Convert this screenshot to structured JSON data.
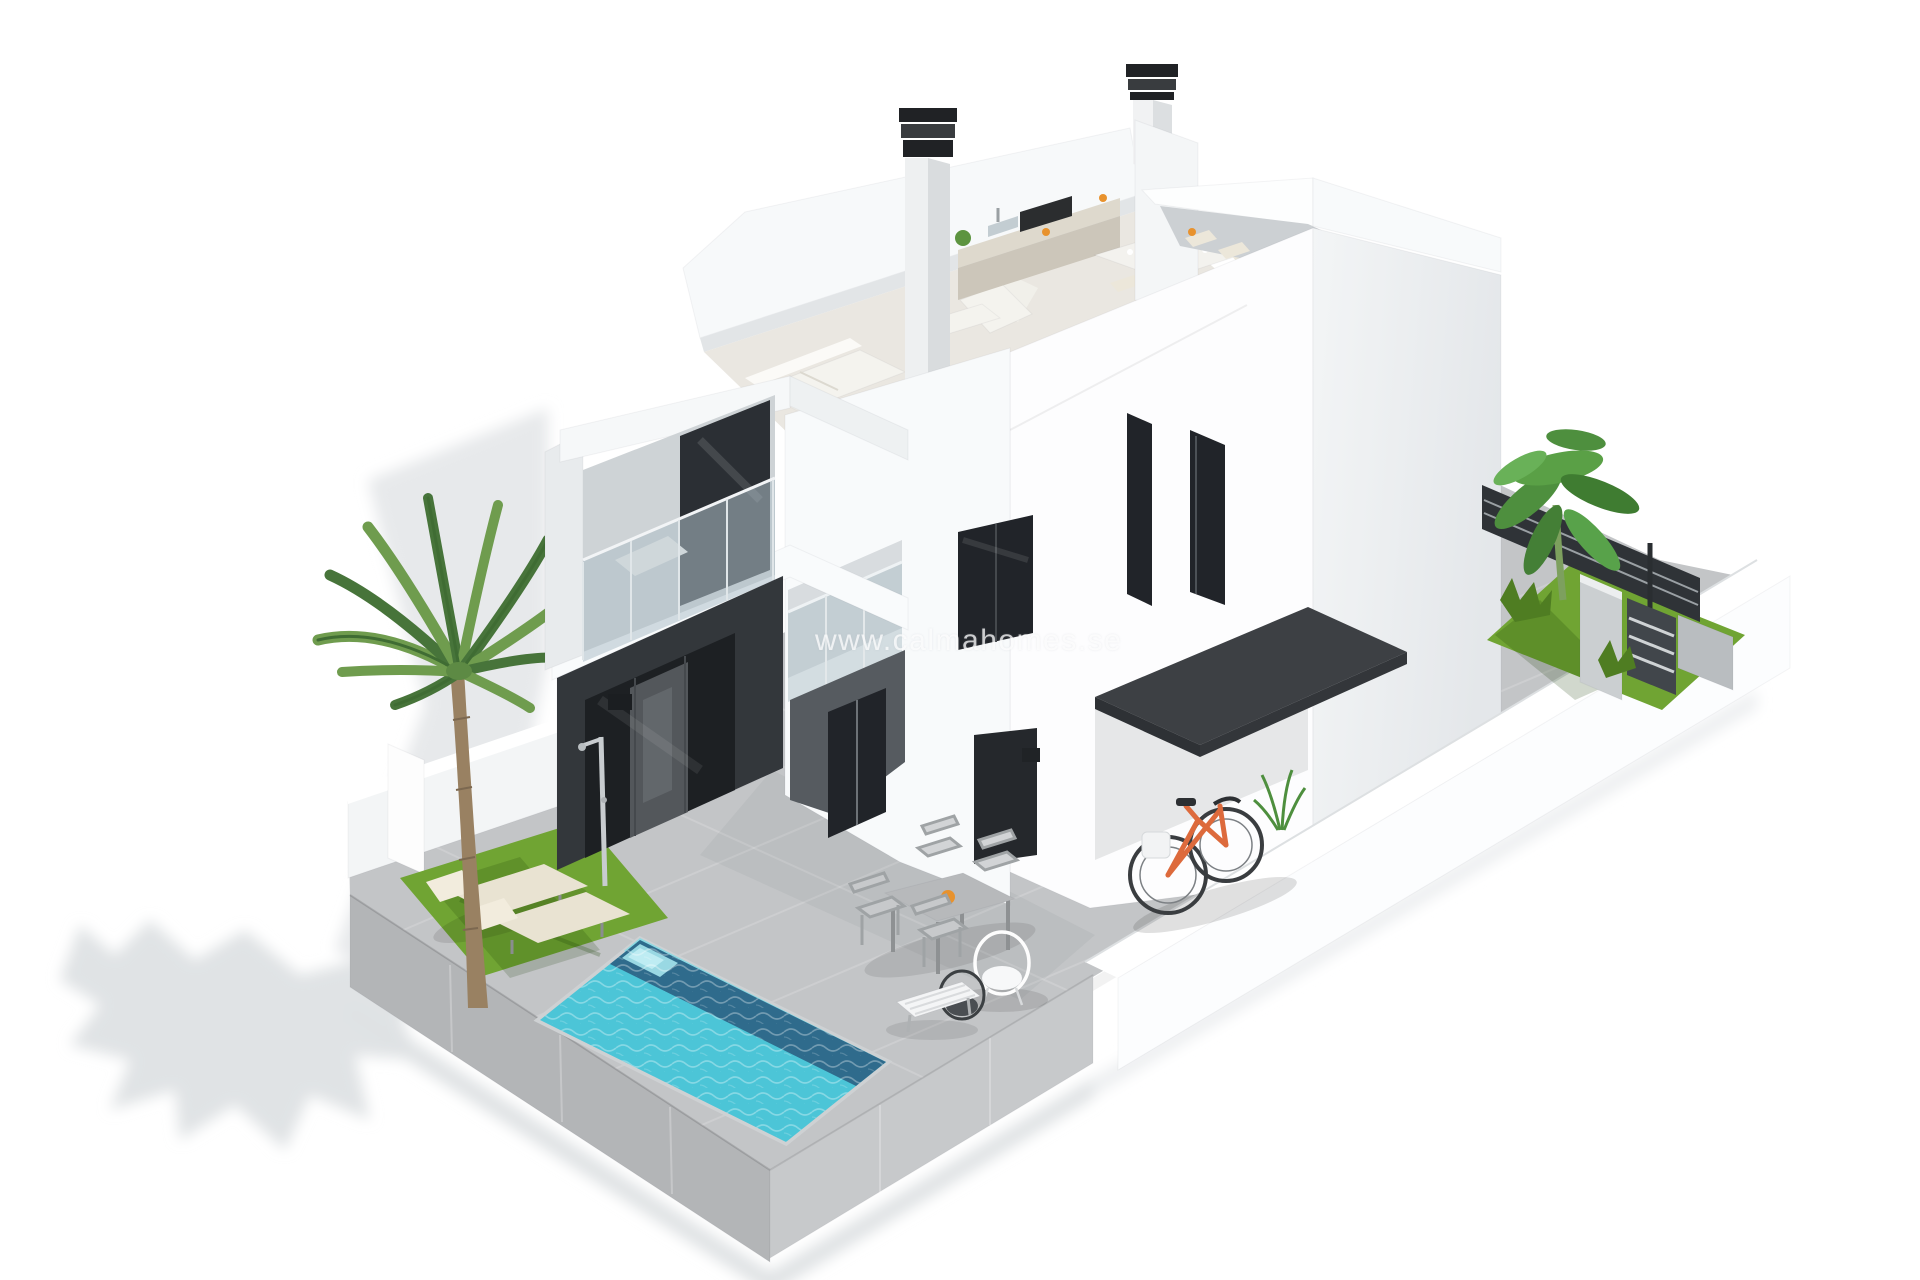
{
  "watermark": {
    "text": "www.calmahomes.se"
  },
  "scene": {
    "description": "Isometric 3D architectural render of a modern two-storey white villa with cut-away roof showing furnished interior (sofa, kitchen counter with hob, dining table), two chimneys, glass balcony, dark-clad ground floor with sliding glass doors, anthracite carport canopy with orange bicycle, private pool, palm tree, sun loungers, outdoor dining terrace, side garden with banana plant, privacy fence and entrance gate, all on a paved plot surrounded by white walls",
    "objects": [
      "modern-villa",
      "cutaway-upper-floor",
      "living-room-sofa",
      "armchair",
      "kitchen-counter",
      "gas-hob",
      "interior-dining-table",
      "chimney",
      "roof-terrace",
      "balcony-glass-balustrade",
      "dark-clad-ground-floor",
      "sliding-glass-doors",
      "entrance-door",
      "carport-canopy",
      "bicycle",
      "outdoor-dining-table",
      "outdoor-chairs",
      "wire-lounge-chairs",
      "swimming-pool",
      "sun-loungers",
      "palm-tree",
      "lawn",
      "outdoor-shower",
      "side-garden",
      "banana-plant",
      "privacy-fence",
      "entrance-gate",
      "perimeter-wall",
      "paved-terrace"
    ],
    "colors": {
      "background": "#ffffff",
      "paving": "#c3c5c7",
      "plinth": "#b3b5b7",
      "plinth-light": "#c7c9cb",
      "wall-white": "#fcfdfe",
      "wall-light": "#f2f4f5",
      "wall-mid": "#e3e6e8",
      "wall-shade": "#cdd2d5",
      "cladding": "#33373b",
      "canopy": "#3d4044",
      "glass-dark": "#212429",
      "glass-light": "#aebfc8",
      "pool-water": "#4cc5d7",
      "pool-deep": "#2b5f82",
      "pool-step": "#a5e4ec",
      "grass": "#70a433",
      "grass-dark": "#4f7d22",
      "frond": "#6f9c4e",
      "frond-dark": "#47743a",
      "trunk": "#998162",
      "lounger": "#e9e3d2",
      "bike": "#dd6a3c",
      "shadow": "#e7e9eb",
      "interior-floor": "#eae7e1",
      "counter": "#ded9cd",
      "furniture": "#f4f3ee",
      "accent-orange": "#e8922d",
      "fence": "#2f3337",
      "gate": "#41464b",
      "pillar": "#cbcfd1"
    }
  }
}
